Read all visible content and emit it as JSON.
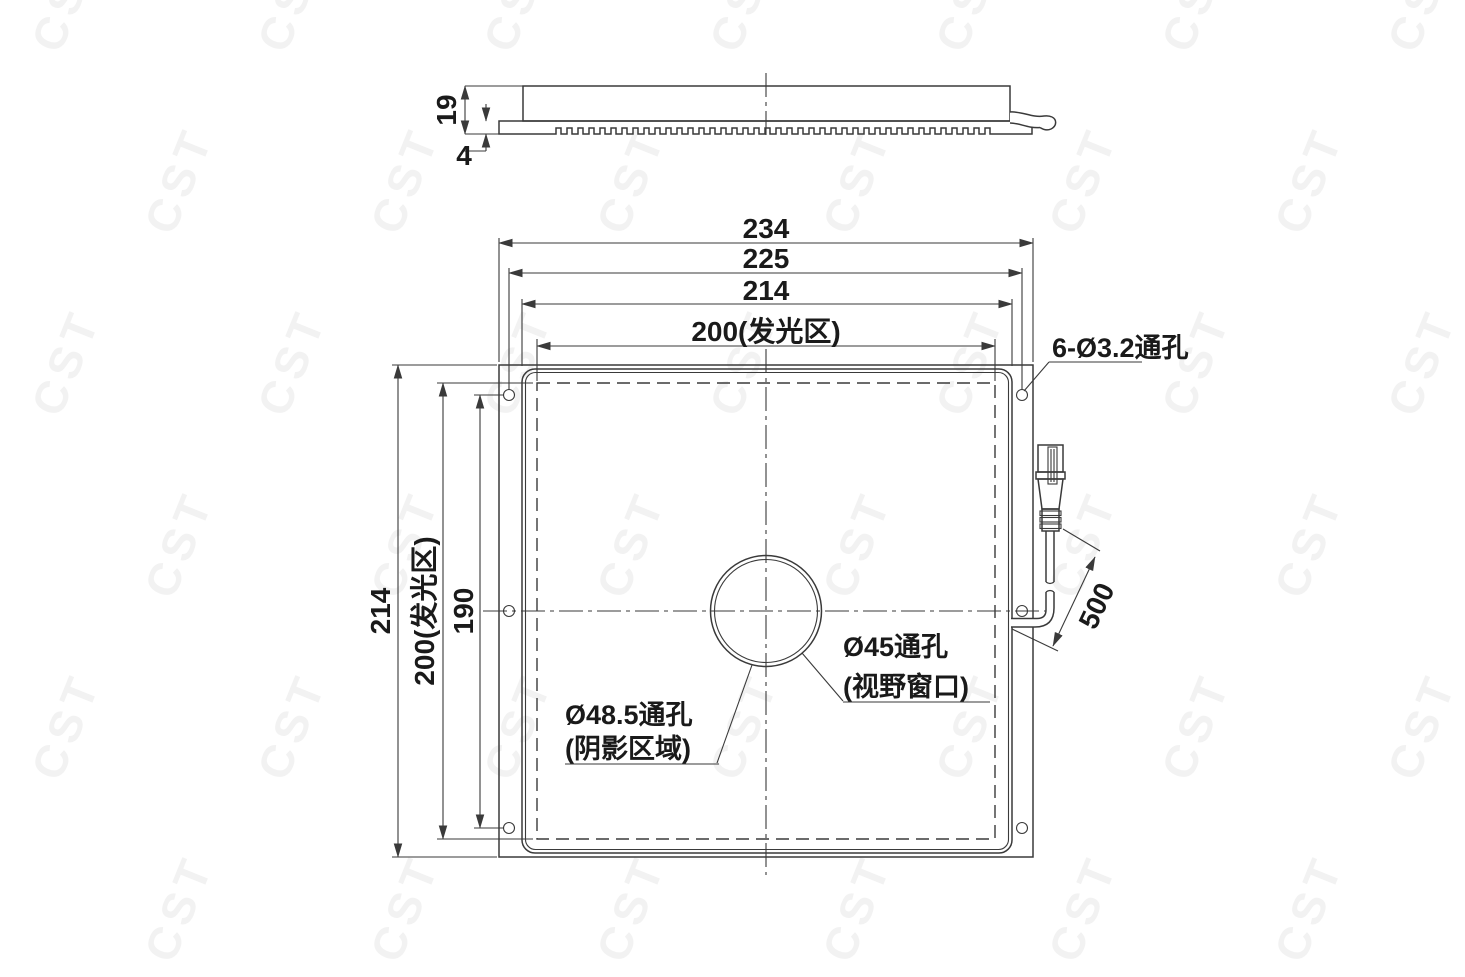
{
  "watermark": {
    "text": "CST"
  },
  "drawing": {
    "side_view": {
      "height_dim": "19",
      "plate_thickness_dim": "4"
    },
    "plan_view": {
      "top_dimensions": {
        "overall": "234",
        "hole_spacing": "225",
        "body": "214",
        "luminous": "200(发光区)"
      },
      "left_dimensions": {
        "body": "214",
        "luminous": "200(发光区)",
        "hole_spacing": "190"
      },
      "mounting_holes_label": "6-Ø3.2通孔",
      "cable_length_label": "500",
      "view_window_label_line1": "Ø45通孔",
      "view_window_label_line2": "(视野窗口)",
      "shadow_area_label_line1": "Ø48.5通孔",
      "shadow_area_label_line2": "(阴影区域)"
    },
    "colors": {
      "line": "#3a3a3a",
      "text": "#1a1a1a",
      "background": "#ffffff"
    }
  }
}
